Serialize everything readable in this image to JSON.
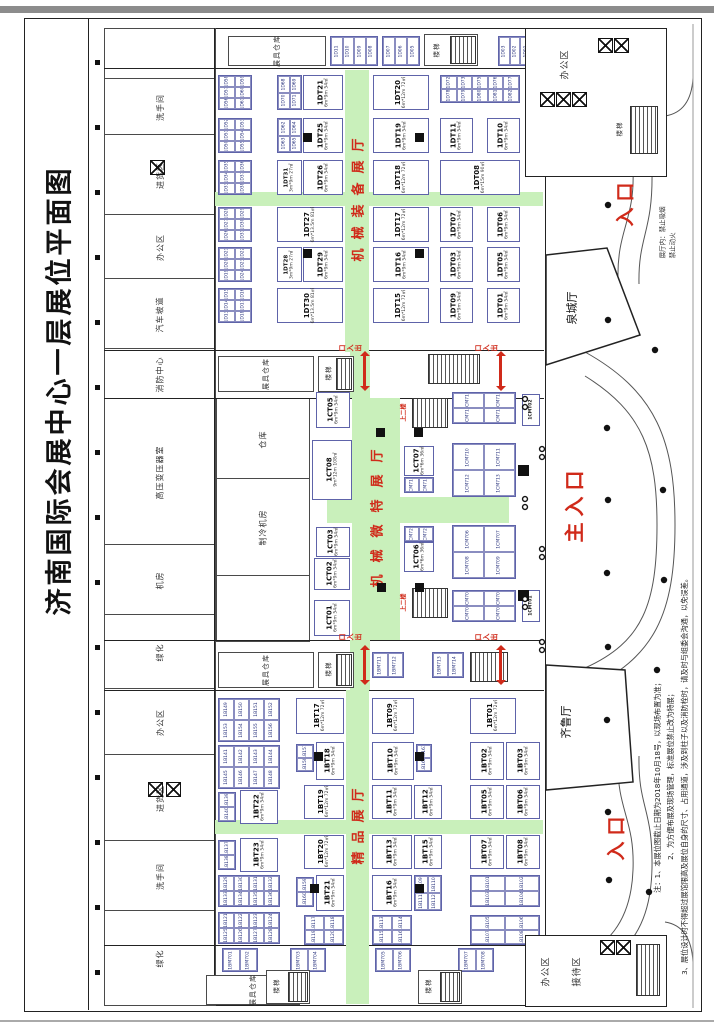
{
  "title": "济南国际会展中心一层展位平面图",
  "colors": {
    "aisle_green": "#c9f0bb",
    "accent_red": "#d02a1a",
    "booth_border": "#5e63a9"
  },
  "entrances": {
    "top": "入口",
    "main": "主入口",
    "bottom": "入口",
    "exit": "出入口",
    "exit_chars": [
      "出",
      "入",
      "口"
    ],
    "upstairs": "上二楼"
  },
  "warning": {
    "line1": "展厅内：禁止吸烟",
    "line2": "禁止动火"
  },
  "notes": {
    "l1": "注：1、本展位图截止日期为2018年10月18号，以现场布置为准；",
    "l2": "2、为方便布展及现场管理，标准展位禁止改为特展；",
    "l3": "3、展位设计时不得超过展馆限高及展位自身的尺寸、占用通道，涉及到柱子以及消防栓时，请及时与组委会沟通，以免误差。"
  },
  "rooms": {
    "restroom": "洗手间",
    "goods": "进货区",
    "office": "办公区",
    "ramp": "汽车坡道",
    "fire": "消防中心",
    "transformer": "高压变压器室",
    "machine": "机房",
    "green": "绿化",
    "warehouse": "仓库",
    "cooling": "制冷机房",
    "store": "展具仓库",
    "stairs": "楼梯",
    "reception": "接待区",
    "quancheng": "泉城厅",
    "qilu": "齐鲁厅"
  },
  "halls": {
    "dt": {
      "name": "机械装备展厅",
      "booths": {
        "t01": {
          "id": "1DT01",
          "sub": "6m*9m 54㎡"
        },
        "t03": {
          "id": "1DT03",
          "sub": "6m*9m 54㎡"
        },
        "t05": {
          "id": "1DT05",
          "sub": "6m*9m 54㎡"
        },
        "t06": {
          "id": "1DT06",
          "sub": "6m*9m 54㎡"
        },
        "t07": {
          "id": "1DT07",
          "sub": "6m*9m 54㎡"
        },
        "t08": {
          "id": "1DT08",
          "sub": "6m*15m 90㎡"
        },
        "t09": {
          "id": "1DT09",
          "sub": "6m*9m 54㎡"
        },
        "t10": {
          "id": "1DT10",
          "sub": "6m*9m 54㎡"
        },
        "t11": {
          "id": "1DT11",
          "sub": "6m*9m 54㎡"
        },
        "t15": {
          "id": "1DT15",
          "sub": "6m*12m 72㎡"
        },
        "t16": {
          "id": "1DT16",
          "sub": "6m*9m 54㎡"
        },
        "t17": {
          "id": "1DT17",
          "sub": "6m*12m 72㎡"
        },
        "t18": {
          "id": "1DT18",
          "sub": "6m*12m 72㎡"
        },
        "t19": {
          "id": "1DT19",
          "sub": "6m*9m 54㎡"
        },
        "t20": {
          "id": "1DT20",
          "sub": "6m*12m 72㎡"
        },
        "t21": {
          "id": "1DT21",
          "sub": "6m*9m 54㎡"
        },
        "t25": {
          "id": "1DT25",
          "sub": "6m*9m 54㎡"
        },
        "t26": {
          "id": "1DT26",
          "sub": "6m*9m 54㎡"
        },
        "t27": {
          "id": "1DT27",
          "sub": "6m*13.5m 81㎡"
        },
        "t28": {
          "id": "1DT28",
          "sub": "3m*9m 27㎡"
        },
        "t29": {
          "id": "1DT29",
          "sub": "6m*9m 54㎡"
        },
        "t30": {
          "id": "1DT30",
          "sub": "6m*13.5m 81㎡"
        },
        "t31": {
          "id": "1DT31",
          "sub": "3m*9m 27㎡"
        }
      }
    },
    "ct": {
      "name": "机械微特展厅",
      "booths": {
        "c01": {
          "id": "1CT01",
          "sub": "6m*9m 54㎡"
        },
        "c02": {
          "id": "1CT02",
          "sub": "6m*9m 54㎡"
        },
        "c03": {
          "id": "1CT03",
          "sub": "6m*9m 54㎡"
        },
        "c05": {
          "id": "1CT05",
          "sub": "6m*9m 54㎡"
        },
        "c06": {
          "id": "1CT06",
          "sub": "6m*6m 36㎡"
        },
        "c07": {
          "id": "1CT07",
          "sub": "6m*6m 36㎡"
        },
        "c08": {
          "id": "1CT08",
          "sub": "9m*12m 108㎡"
        }
      }
    },
    "bt": {
      "name": "精品展厅",
      "booths": {
        "b01": {
          "id": "1BT01",
          "sub": "6m*12m 72㎡"
        },
        "b02": {
          "id": "1BT02",
          "sub": "6m*9m 54㎡"
        },
        "b03": {
          "id": "1BT03",
          "sub": "6m*9m 54㎡"
        },
        "b05": {
          "id": "1BT05",
          "sub": "6m*9m 54㎡"
        },
        "b06": {
          "id": "1BT06",
          "sub": "6m*9m 54㎡"
        },
        "b07": {
          "id": "1BT07",
          "sub": "6m*9m 54㎡"
        },
        "b08": {
          "id": "1BT08",
          "sub": "6m*9m 54㎡"
        },
        "b09": {
          "id": "1BT09",
          "sub": "6m*12m 72㎡"
        },
        "b10": {
          "id": "1BT10",
          "sub": "6m*9m 54㎡"
        },
        "b11": {
          "id": "1BT11",
          "sub": "6m*9m 54㎡"
        },
        "b12": {
          "id": "1BT12",
          "sub": "6m*9m 54㎡"
        },
        "b13": {
          "id": "1BT13",
          "sub": "6m*9m 54㎡"
        },
        "b15": {
          "id": "1BT15",
          "sub": "6m*9m 54㎡"
        },
        "b16": {
          "id": "1BT16",
          "sub": "6m*9m 54㎡"
        },
        "b17": {
          "id": "1BT17",
          "sub": "6m*12m 72㎡"
        },
        "b18": {
          "id": "1BT18",
          "sub": "6m*9m 54㎡"
        },
        "b19": {
          "id": "1BT19",
          "sub": "6m*12m 72㎡"
        },
        "b20": {
          "id": "1BT20",
          "sub": "6m*12m 72㎡"
        },
        "b21": {
          "id": "1BT21",
          "sub": "6m*9m 54㎡"
        },
        "b22": {
          "id": "1BT22",
          "sub": "6m*9m 54㎡"
        },
        "b23": {
          "id": "1BT23",
          "sub": "6m*9m 54㎡"
        }
      }
    }
  },
  "cells": {
    "dt_a1": [
      "1D58",
      "1D59",
      "1D57",
      "1D60",
      "1D56",
      "1D61"
    ],
    "dt_a2": [
      "1D52",
      "1D53",
      "1D51",
      "1D54",
      "1D50",
      "1D55"
    ],
    "dt_a3": [
      "1D35",
      "1D36",
      "1D34",
      "1D37",
      "1D33",
      "1D38"
    ],
    "dt_a4": [
      "1D28",
      "1D29",
      "1D27",
      "1D30",
      "1D26",
      "1D31"
    ],
    "dt_a5": [
      "1D21",
      "1D22",
      "1D20",
      "1D23",
      "1D19",
      "1D24"
    ],
    "dt_a6": [
      "1D15",
      "1D16",
      "1D14",
      "1D17",
      "1D13",
      "1D18"
    ],
    "dt_b1": [
      "1D68",
      "1D69",
      "1D70",
      "1D71"
    ],
    "dt_b2": [
      "1D62",
      "1D64",
      "1D63",
      "1D65"
    ],
    "dt_c1": [
      "1D72",
      "1D73",
      "1D75",
      "1D76",
      "1D77",
      "1D78",
      "1D79",
      "1D80",
      "1D81",
      "1D82"
    ],
    "dt_s1": [
      "1D11",
      "1D10",
      "1D09",
      "1D08"
    ],
    "dt_s2": [
      "1D07",
      "1D06",
      "1D05"
    ],
    "dt_s3": [
      "1D03",
      "1D02",
      "1D01"
    ],
    "ct_t": [
      "1CM714",
      "1CM715",
      "1CM716",
      "1CM717"
    ],
    "ct_r1": [
      "1CM710",
      "1CM711",
      "1CM712",
      "1CM713"
    ],
    "ct_r2": [
      "1CM706",
      "1CM707",
      "1CM708",
      "1CM709"
    ],
    "ct_b": [
      "1CM701",
      "1CM702",
      "1CM703",
      "1CM704"
    ],
    "ct_p1": [
      "1CM718",
      "1CM719"
    ],
    "ct_p2": [
      "1CM720",
      "1CM721"
    ],
    "cmt02": "1CMT02",
    "cmt01": "1CMT01",
    "bt_a1": [
      "1B149",
      "1B150",
      "1B151",
      "1B152",
      "1B153",
      "1B154",
      "1B155",
      "1B156"
    ],
    "bt_a2": [
      "1B141",
      "1B142",
      "1B143",
      "1B144",
      "1B145",
      "1B146",
      "1B147",
      "1B148"
    ],
    "bt_a3": [
      "1B129",
      "1B130",
      "1B131",
      "1B132",
      "1B133",
      "1B134",
      "1B135",
      "1B136"
    ],
    "bt_a4": [
      "1B121",
      "1B122",
      "1B123",
      "1B124",
      "1B125",
      "1B126",
      "1B127",
      "1B128"
    ],
    "bt_p22": [
      "1B139",
      "1B140"
    ],
    "bt_p23": [
      "1B137",
      "1B138"
    ],
    "bt_p18": [
      "1B157",
      "1B158"
    ],
    "bt_p21": [
      "1B159",
      "1B160"
    ],
    "bt_p10": [
      "1B161",
      "1B162"
    ],
    "bt_g16": [
      "1B109",
      "1B110",
      "1B111",
      "1B112"
    ],
    "bt_gB": [
      "1B117",
      "1B118",
      "1B119",
      "1B120"
    ],
    "bt_gC": [
      "1B113",
      "1B114",
      "1B115",
      "1B116"
    ],
    "bt_gD1": [
      "1B101",
      "1B102",
      "1B103",
      "1B104"
    ],
    "bt_gD2": [
      "1B105",
      "1B106",
      "1B107",
      "1B108"
    ],
    "st2a": [
      "1BM711",
      "1BM712"
    ],
    "st2b": [
      "1BM713",
      "1BM714"
    ],
    "bt_m1": [
      "1BM701",
      "1BM702"
    ],
    "bt_m2": [
      "1BM703",
      "1BM704"
    ],
    "bt_m3": [
      "1BM705",
      "1BM706"
    ],
    "bt_m4": [
      "1BM707",
      "1BM708"
    ]
  }
}
